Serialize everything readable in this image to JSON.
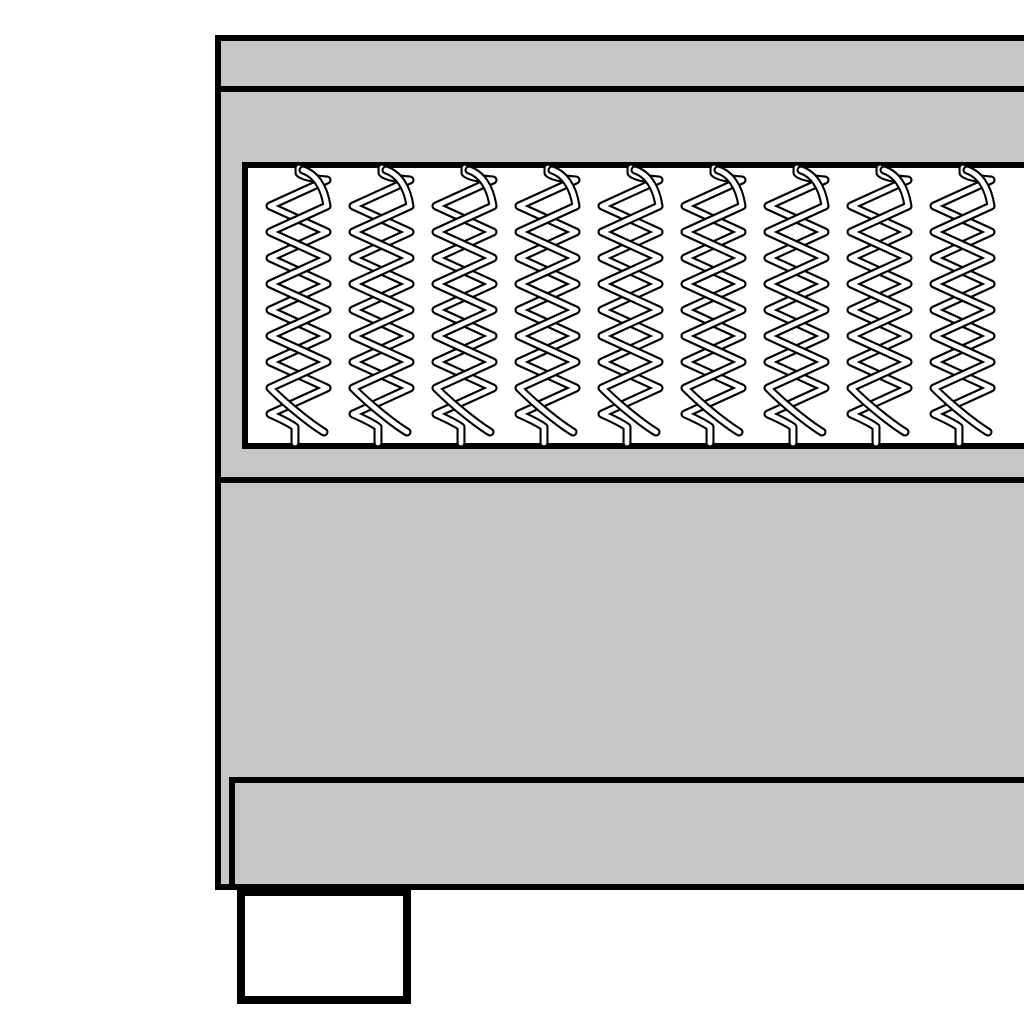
{
  "illustration": {
    "description": "Cross-section product illustration of a boxspring bed: top rail band, mattress layer with exposed pocket coil springs, deep box base, inset bottom rail and a rectangular foot; bed extends beyond the right edge of the image",
    "colors": {
      "outline": "#000000",
      "bed_gray": "#c6c6c6",
      "panel_white": "#ffffff",
      "background": "#ffffff"
    },
    "springs": {
      "count": 9,
      "start_x": 270,
      "spacing": 83,
      "coil_width": 57,
      "top": 168,
      "coil_height": 275,
      "black_stroke": 9,
      "white_stroke": 4.8
    }
  }
}
